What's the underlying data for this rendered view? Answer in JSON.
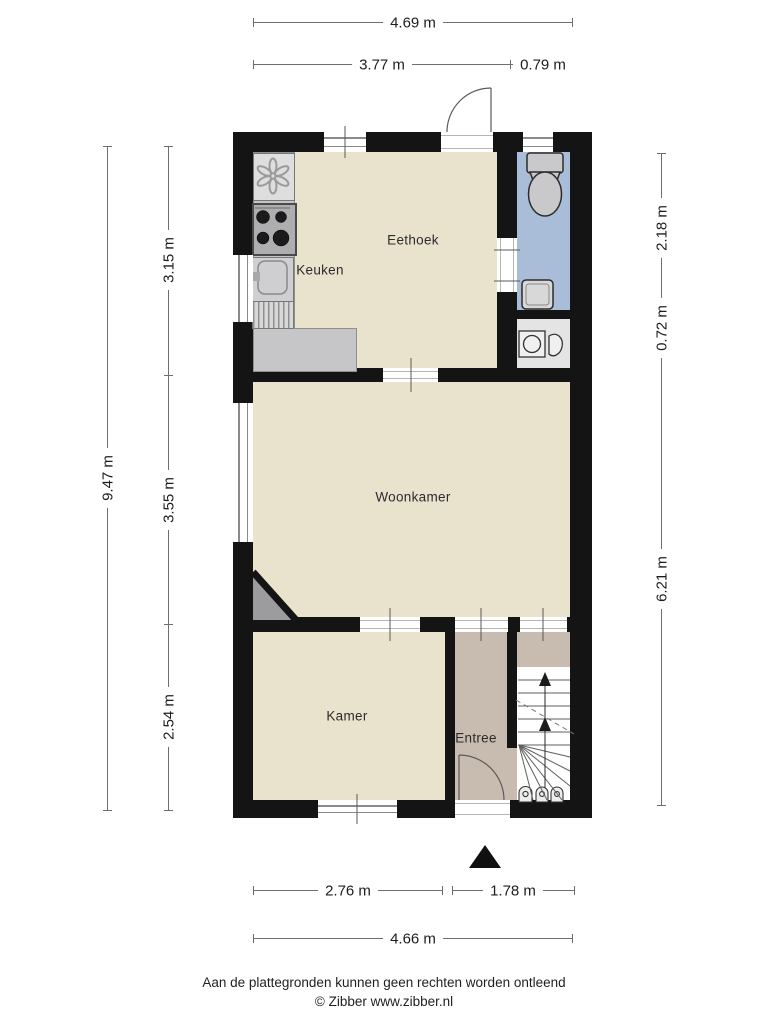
{
  "rooms": {
    "eethoek": "Eethoek",
    "keuken": "Keuken",
    "woonkamer": "Woonkamer",
    "kamer": "Kamer",
    "entree": "Entree"
  },
  "dimensions": {
    "top_total": "4.69 m",
    "top_left": "3.77 m",
    "top_right": "0.79 m",
    "left_total": "9.47 m",
    "left_seg1": "3.15 m",
    "left_seg2": "3.55 m",
    "left_seg3": "2.54 m",
    "right_seg1": "2.18 m",
    "right_seg2": "0.72 m",
    "right_seg3": "6.21 m",
    "bottom_left": "2.76 m",
    "bottom_right": "1.78 m",
    "bottom_total": "4.66 m"
  },
  "footer": {
    "disclaimer": "Aan de plattegronden kunnen geen rechten worden ontleend",
    "copyright": "© Zibber www.zibber.nl"
  },
  "icons": {
    "fan": "fan-icon",
    "stove": "stove-burners-icon",
    "sink": "kitchen-sink-icon",
    "drainer": "drainer-icon",
    "toilet": "toilet-icon",
    "fountain": "fountain-sink-icon",
    "washer": "washing-machine-icon",
    "meters": "meter-icon",
    "stairs_arrow": "stairs-up-arrow-icon",
    "north": "north-triangle-icon"
  },
  "colors": {
    "floor": "#e9e3cd",
    "entree_floor": "#c8bcb0",
    "wc_floor": "#a9bdd9",
    "counter": "#c6c6c8",
    "closet": "#e4e4e4",
    "wall": "#141414"
  }
}
